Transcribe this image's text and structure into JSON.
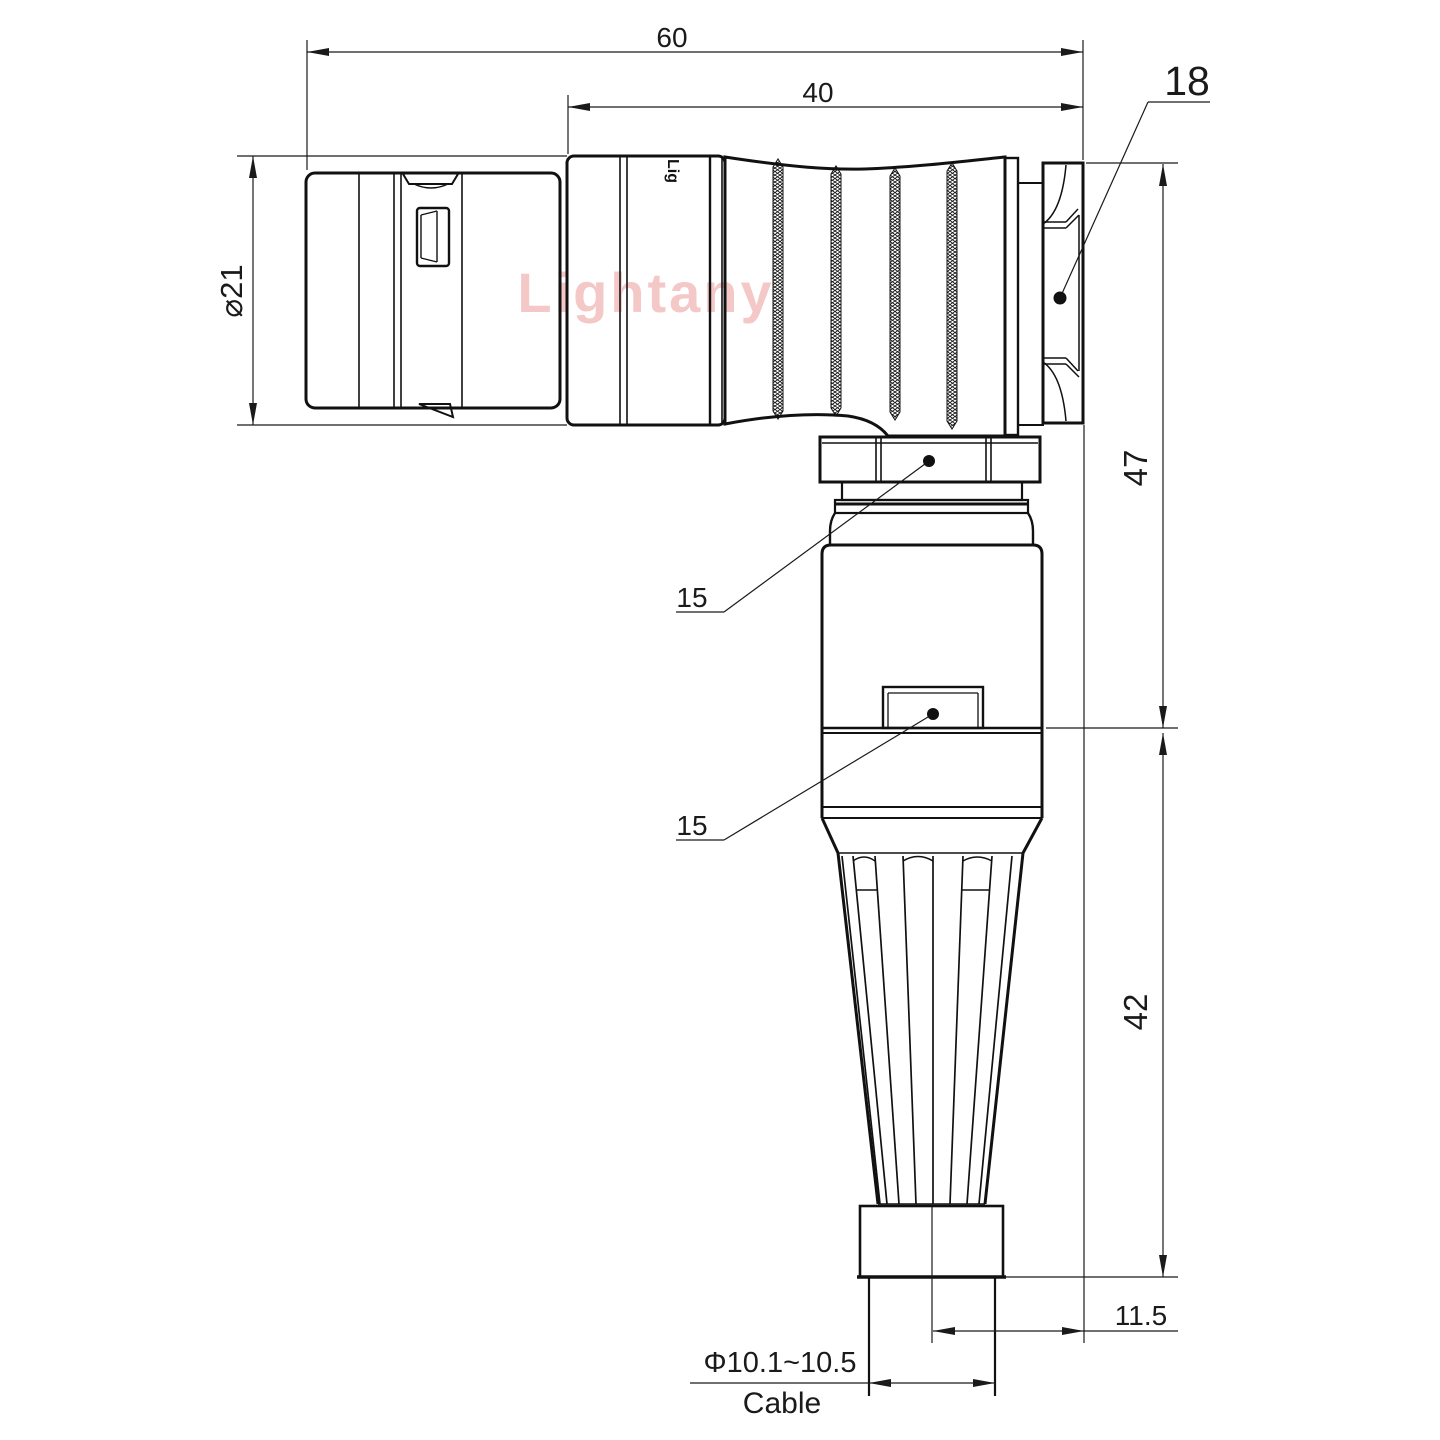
{
  "branding": {
    "watermark": "Lightany",
    "engraving": "Lig"
  },
  "dimensions": {
    "overall_length": "60",
    "front_section_length": "40",
    "hex_across_flats": "18",
    "front_diameter": "⌀21",
    "vertical_upper": "47",
    "vertical_lower": "42",
    "cable_offset": "11.5",
    "cable_diameter": "Φ10.1~10.5",
    "cable_label": "Cable",
    "callout_coupling_nut": "15",
    "callout_backshell": "15"
  },
  "colors": {
    "line": "#111111",
    "watermark": "#f5c8c8",
    "background": "#ffffff"
  }
}
